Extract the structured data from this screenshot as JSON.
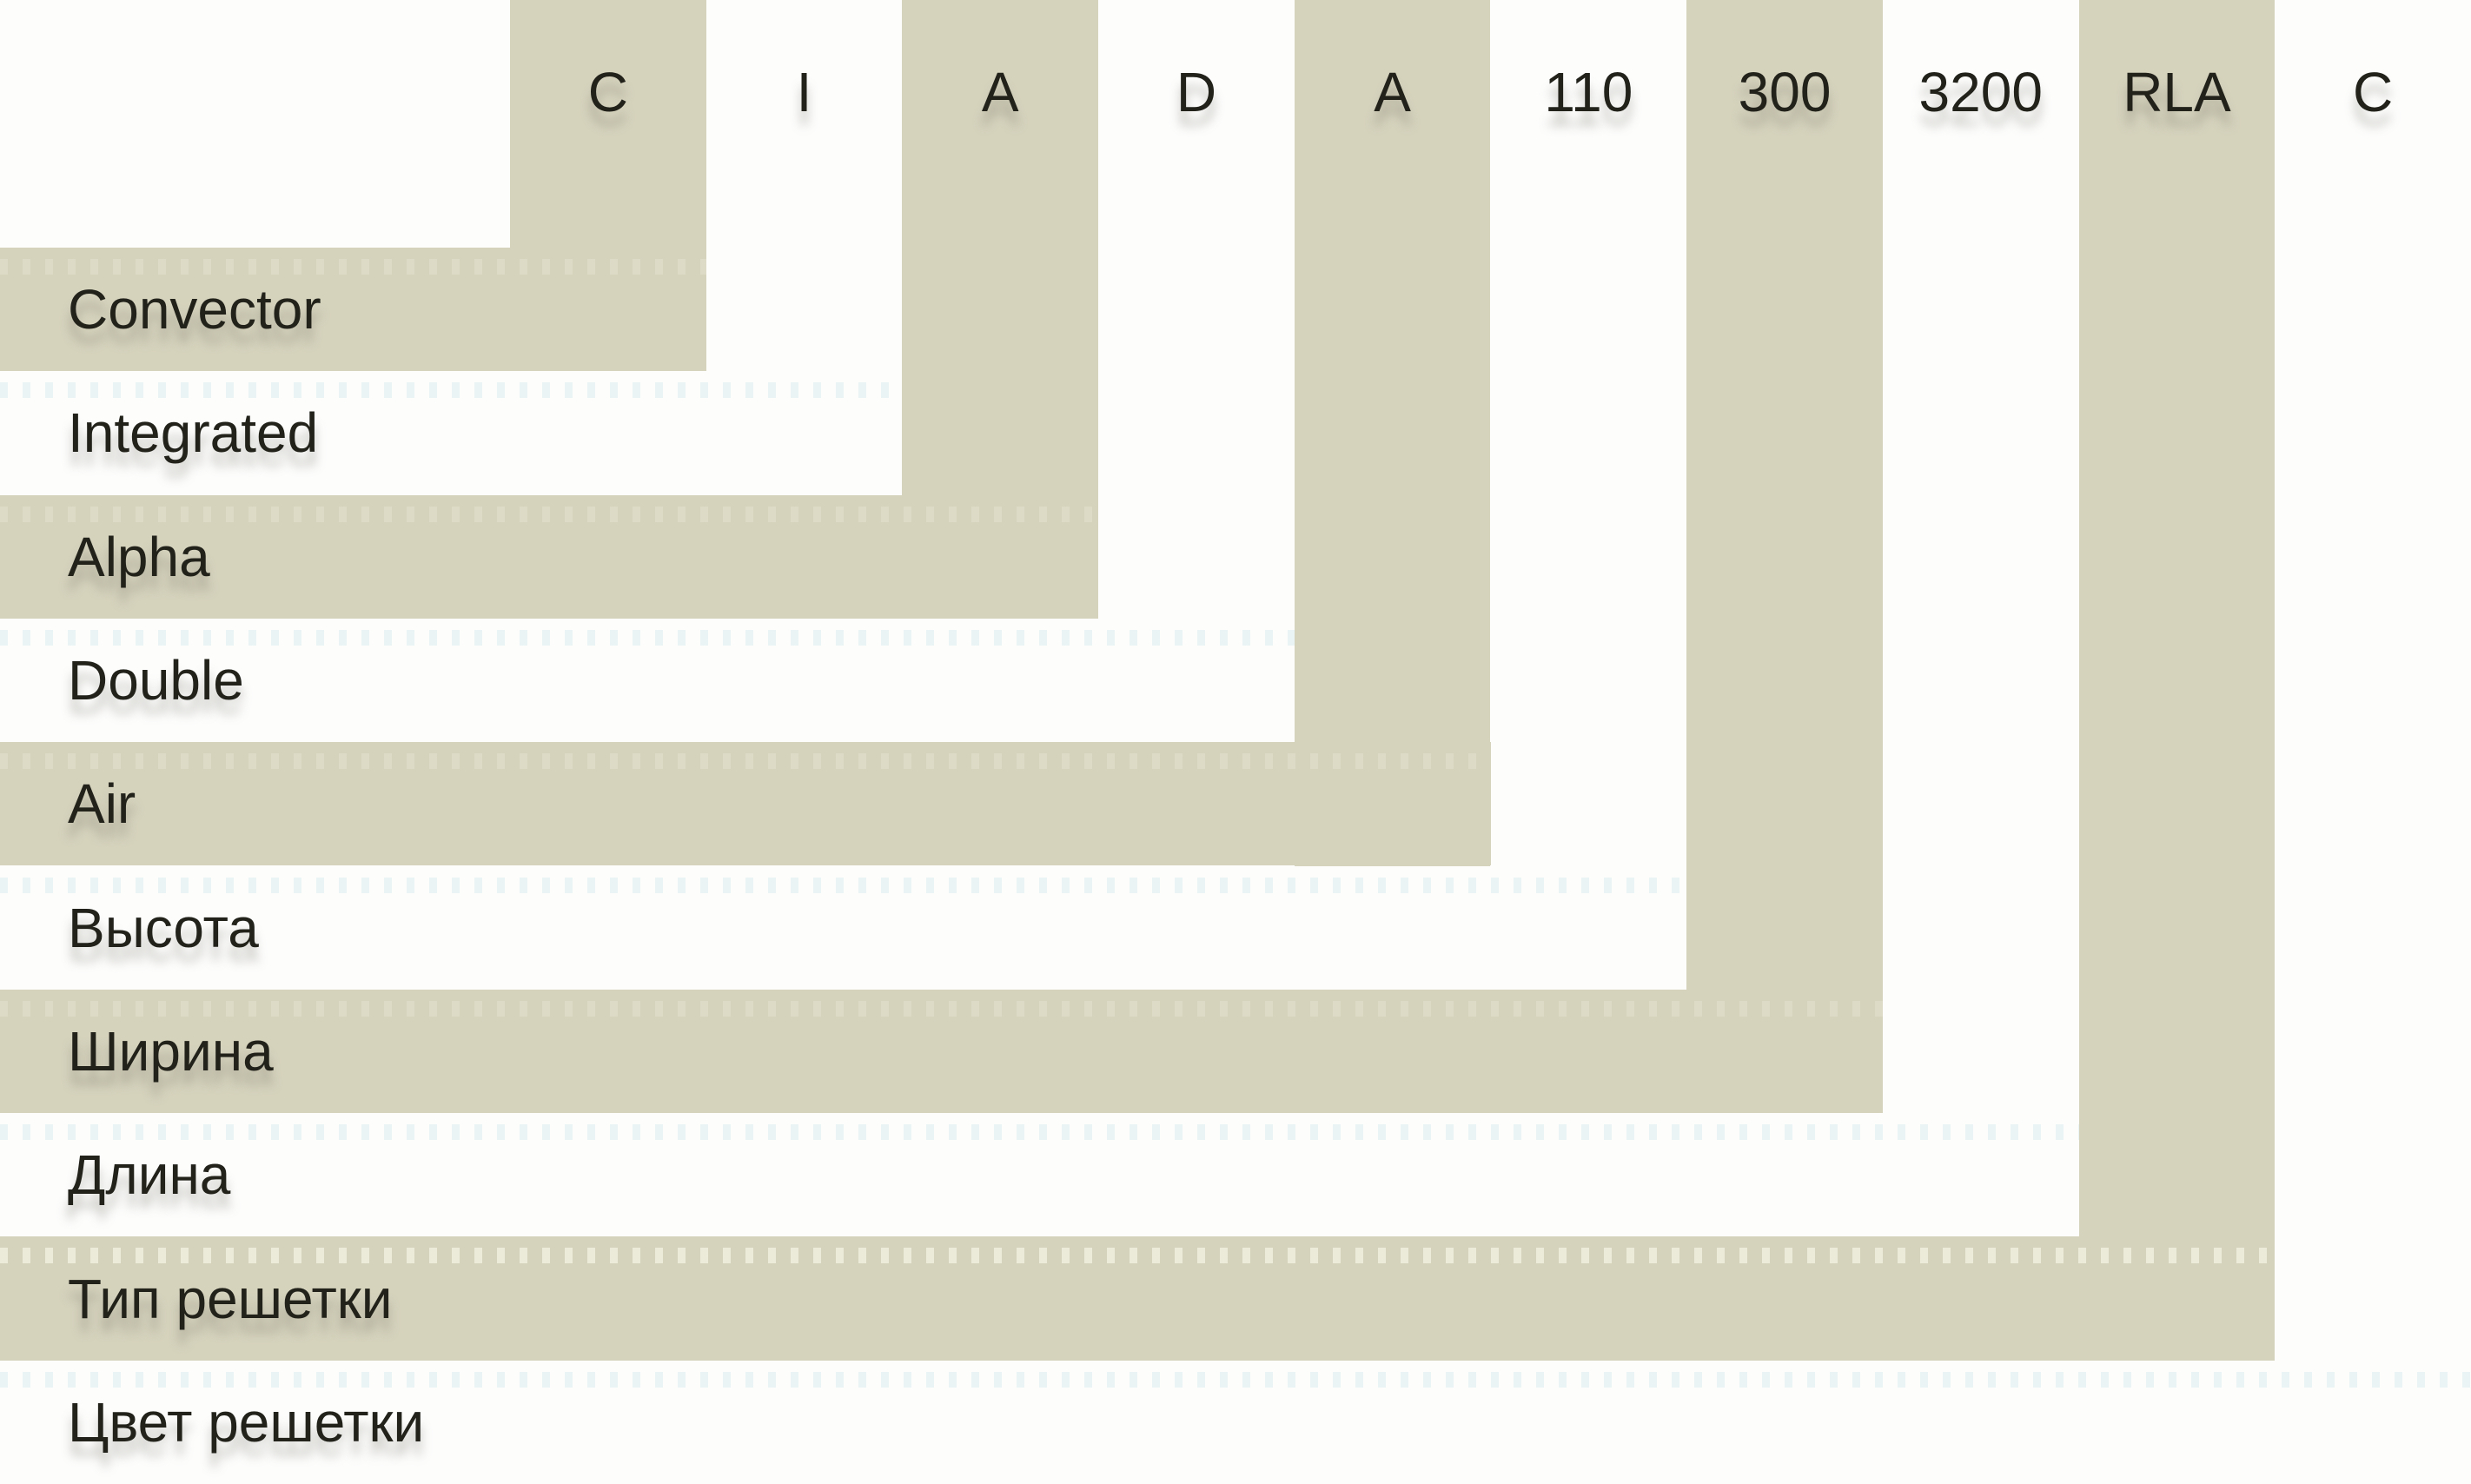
{
  "diagram": {
    "description": "Convector model nomenclature decoder",
    "rows": [
      {
        "code": "C",
        "label": "Convector",
        "shaded": true
      },
      {
        "code": "I",
        "label": "Integrated",
        "shaded": false
      },
      {
        "code": "A",
        "label": "Alpha",
        "shaded": true
      },
      {
        "code": "D",
        "label": "Double",
        "shaded": false
      },
      {
        "code": "A",
        "label": "Air",
        "shaded": true
      },
      {
        "code": "110",
        "label": "Высота",
        "shaded": false
      },
      {
        "code": "300",
        "label": "Ширина",
        "shaded": true
      },
      {
        "code": "3200",
        "label": "Длина",
        "shaded": false
      },
      {
        "code": "RLA",
        "label": "Тип решетки",
        "shaded": true
      },
      {
        "code": "C",
        "label": "Цвет решетки",
        "shaded": false
      }
    ],
    "colors": {
      "band_beige": "#d6d3bd",
      "background_white": "#fdfdfc",
      "text": "#22221b",
      "dots_strong": "rgba(255,255,242,0.55)",
      "dots_on_beige": "rgba(255,255,242,0.18)",
      "dots_on_white": "rgba(135,200,205,0.16)"
    },
    "dotted_row_label": "Тип решетки"
  }
}
